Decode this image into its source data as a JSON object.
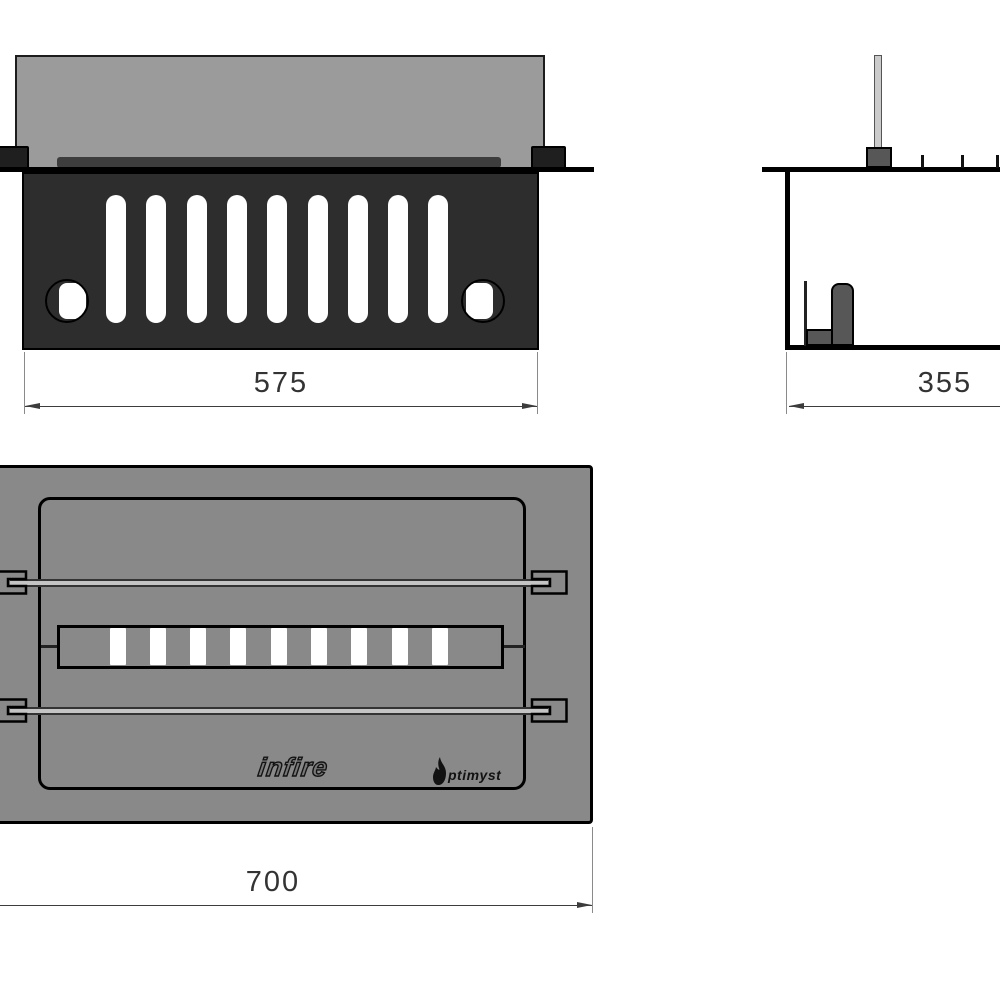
{
  "drawing": {
    "views": {
      "front": {
        "dim_label": "575",
        "grille_slot_count": 9,
        "mounting_hole_count": 2
      },
      "side": {
        "dim_label": "355",
        "flange_tab_count": 3
      },
      "top": {
        "dim_label": "700",
        "burner_slot_count": 9,
        "rod_count": 2,
        "logo_infire": "infire",
        "logo_optimyst": "ptimyst"
      }
    },
    "colors": {
      "panel_dark": "#2d2d2d",
      "back_gray": "#9b9b9b",
      "body_gray": "#898989",
      "fitting_gray": "#575757",
      "rod_light": "#cbcbcb",
      "bar_dark": "#3d3d3d",
      "edge_black": "#000000",
      "dim_line": "#3c3c3c",
      "slot_white": "#ffffff"
    }
  }
}
